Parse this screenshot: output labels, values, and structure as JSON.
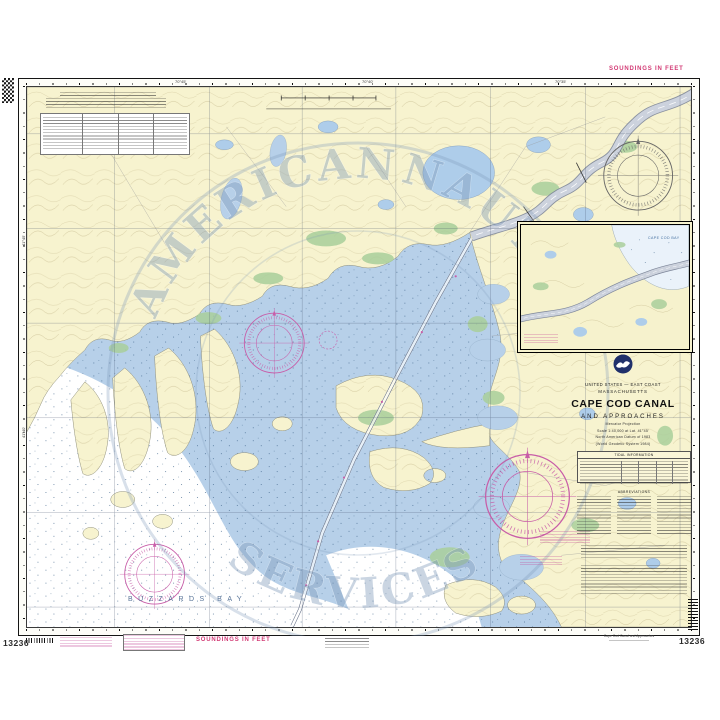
{
  "chart": {
    "number": "13236",
    "soundings_top": "SOUNDINGS IN FEET",
    "soundings_bottom": "SOUNDINGS IN FEET",
    "bottom_caption": "Cape Cod Canal and Approaches"
  },
  "title_block": {
    "country_line": "UNITED STATES — EAST COAST",
    "state_line": "MASSACHUSETTS",
    "title": "CAPE COD CANAL",
    "subtitle": "AND APPROACHES",
    "projection_lines": [
      "Mercator Projection",
      "Scale 1:40,000 at Lat. 41°45'",
      "North American Datum of 1983",
      "(World Geodetic System 1984)"
    ],
    "tidal_table_title": "TIDAL INFORMATION",
    "abbreviations_title": "ABBREVIATIONS"
  },
  "map_labels": {
    "bay": "BUZZARDS BAY",
    "inset_bay": "CAPE COD BAY"
  },
  "watermark": {
    "word_top": "AMERICAN",
    "word_mid": "NAUTICAL",
    "word_bottom": "SERVICES"
  },
  "graticule": {
    "top": [
      "70°45'",
      "70°40'",
      "70°35'"
    ],
    "left": [
      "41°45'",
      "41°40'"
    ]
  },
  "colors": {
    "land": "#f7f3cf",
    "water": "#b7d0e9",
    "deep_water": "#ffffff",
    "marsh": "#a9cf9b",
    "canal": "#ccd2dd",
    "magenta": "#c85da8",
    "soundings_note": "#d23a74",
    "watermark": "#7d98b8",
    "border": "#151515"
  }
}
